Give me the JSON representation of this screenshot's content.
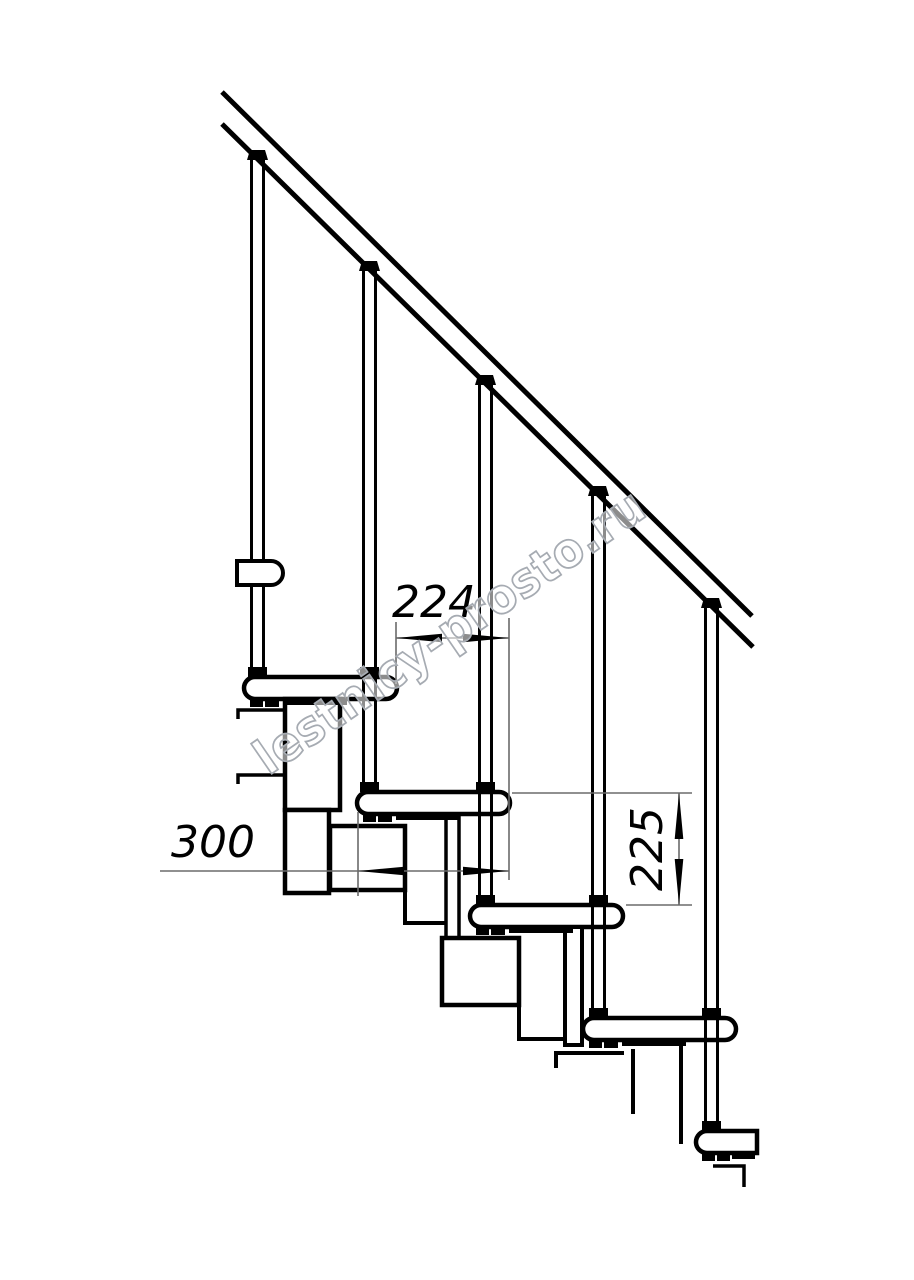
{
  "diagram": {
    "background": "#ffffff",
    "ink_color": "#000000",
    "dim_color": "#6b6b6b",
    "treads_visible": 5,
    "balusters_visible": 5,
    "dimensions": [
      {
        "id": "step-run",
        "value": "224",
        "orientation": "horizontal"
      },
      {
        "id": "tread-depth",
        "value": "300",
        "orientation": "horizontal"
      },
      {
        "id": "step-rise",
        "value": "225",
        "orientation": "vertical"
      }
    ]
  },
  "watermark": {
    "text": "lestnicy-prosto.ru",
    "color": "#a6abb2"
  }
}
